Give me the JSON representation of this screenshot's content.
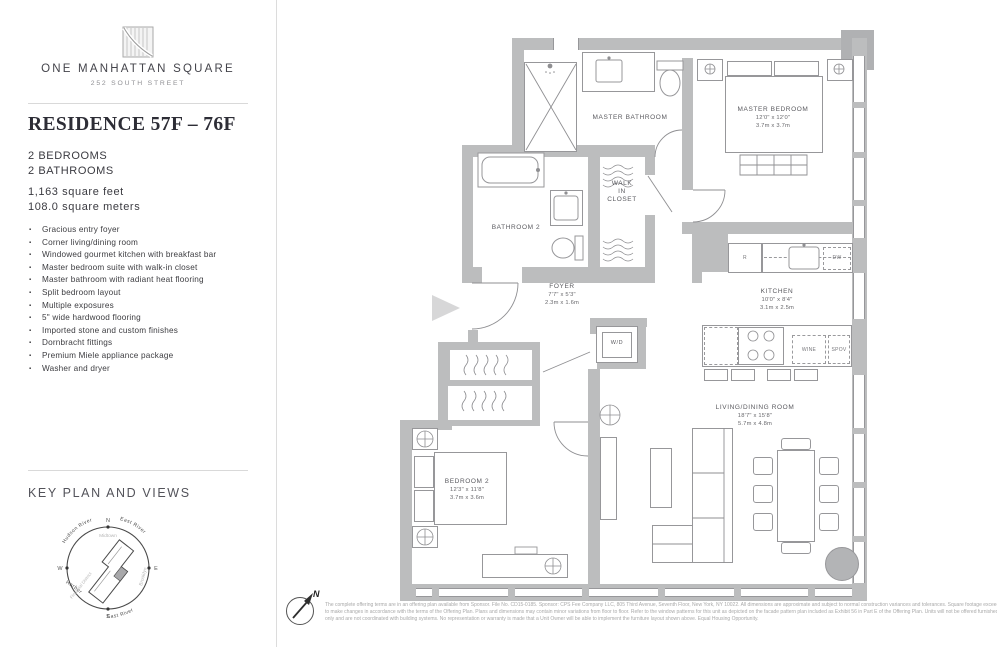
{
  "brand": {
    "name": "ONE MANHATTAN SQUARE",
    "address": "252 SOUTH STREET"
  },
  "residence": {
    "title": "RESIDENCE 57F – 76F",
    "bed": "2 BEDROOMS",
    "bath": "2 BATHROOMS",
    "sqft": "1,163 square feet",
    "sqm": "108.0 square meters",
    "features": [
      "Gracious entry foyer",
      "Corner living/dining room",
      "Windowed gourmet kitchen with breakfast bar",
      "Master bedroom suite with walk-in closet",
      "Master bathroom with radiant heat flooring",
      "Split bedroom layout",
      "Multiple exposures",
      "5\" wide hardwood flooring",
      "Imported stone and custom finishes",
      "Dornbracht fittings",
      "Premium Miele appliance package",
      "Washer and dryer"
    ]
  },
  "key_plan": {
    "title": "KEY PLAN AND VIEWS",
    "compass": {
      "n": "N",
      "e": "E",
      "s": "S",
      "w": "W"
    },
    "outer": {
      "nw": "Hudson River",
      "ne": "East River",
      "sw": "Harbor",
      "se": "East River"
    },
    "inner": {
      "top": "Midtown",
      "right": "Brooklyn",
      "left": "Financial District"
    }
  },
  "plan": {
    "north": "N",
    "rooms": {
      "master_bathroom": {
        "name": "MASTER BATHROOM"
      },
      "master_bedroom": {
        "name": "MASTER BEDROOM",
        "ft": "12'0\" x 12'0\"",
        "m": "3.7m x 3.7m"
      },
      "bathroom2": {
        "name": "BATHROOM 2"
      },
      "wic": {
        "name": "WALK\nIN\nCLOSET"
      },
      "foyer": {
        "name": "FOYER",
        "ft": "7'7\" x 5'3\"",
        "m": "2.3m x 1.6m"
      },
      "kitchen": {
        "name": "KITCHEN",
        "ft": "10'0\" x 8'4\"",
        "m": "3.1m x 2.5m"
      },
      "living": {
        "name": "LIVING/DINING ROOM",
        "ft": "18'7\" x 15'8\"",
        "m": "5.7m x 4.8m"
      },
      "bedroom2": {
        "name": "BEDROOM 2",
        "ft": "12'3\" x 11'8\"",
        "m": "3.7m x 3.6m"
      },
      "wd": {
        "name": "W/D"
      }
    },
    "appliances": {
      "r": "R",
      "dw": "DW",
      "wine": "WINE",
      "spov": "SPOV"
    }
  },
  "disclaimer": {
    "l1": "The complete offering terms are in an offering plan available from Sponsor. File No. CD15-0185. Sponsor: CPS Fee Company LLC, 805 Third Avenue, Seventh Floor, New York, NY 10022.  All dimensions are approximate and subject to normal construction variances and tolerances. Square footage exceeds the usable floor area. Sponsor reserves the right",
    "l2": "to make changes in accordance with the terms of the Offering Plan. Plans and dimensions may contain minor variations from floor to floor. Refer to the window patterns for this unit as depicted on the facade pattern plan included as Exhibit 56 in Part E of the Offering Plan. Units will not be offered furnished. Furniture layouts shown are for concept",
    "l3": "only and are not coordinated with building systems.  No representation or warranty is made that a Unit Owner will be able to implement the furniture layout shown above. Equal Housing Opportunity."
  },
  "colors": {
    "wall": "#bcbdbe",
    "line": "#97979a"
  }
}
